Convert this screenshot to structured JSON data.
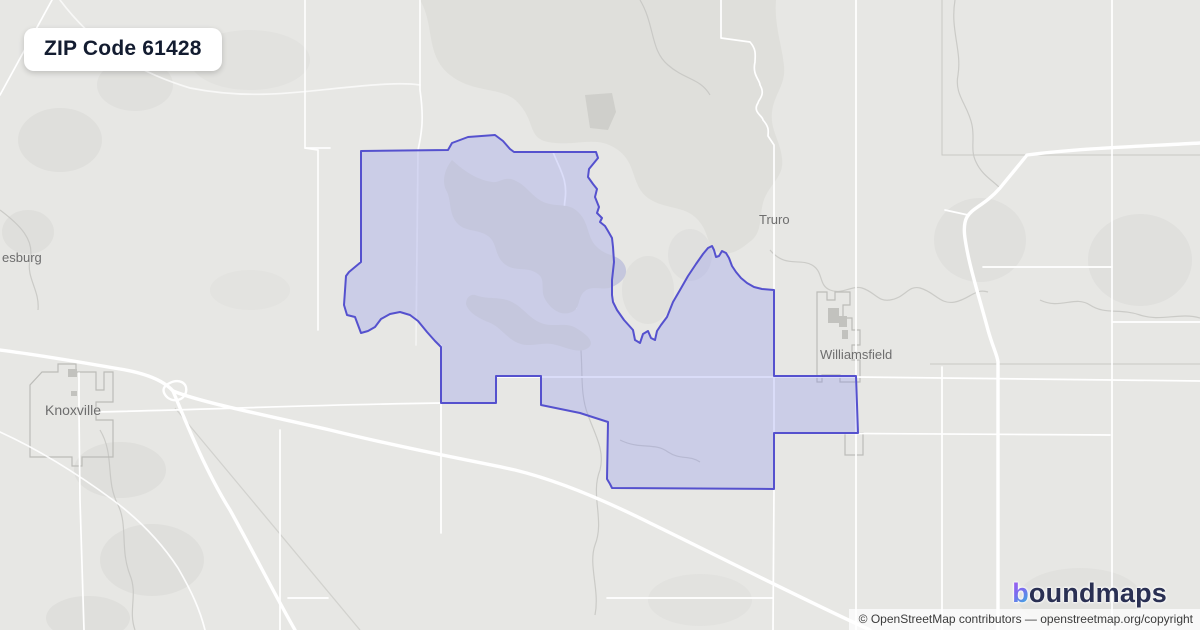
{
  "title_badge": {
    "text": "ZIP Code 61428"
  },
  "map": {
    "type": "zip-code-boundary-map",
    "highlighted_zip": "61428",
    "places": [
      {
        "name": "esburg"
      },
      {
        "name": "Knoxville"
      },
      {
        "name": "Truro"
      },
      {
        "name": "Williamsfield"
      }
    ]
  },
  "branding": {
    "logo_b": "b",
    "logo_rest": "oundmaps"
  },
  "attribution": {
    "text": "© OpenStreetMap contributors — openstreetmap.org/copyright"
  },
  "colors": {
    "map_background": "#e7e7e4",
    "terrain": "#d8d8d4",
    "boundary_stroke": "#5551ce",
    "boundary_fill": "#8287f0",
    "lake": "#c5c7dd",
    "road": "#ffffff",
    "place_label": "#6e6e6e",
    "badge_text": "#131c30",
    "logo_text": "#2a3053",
    "logo_gradient_start": "#a55bf0",
    "logo_gradient_end": "#2fb8dd"
  }
}
